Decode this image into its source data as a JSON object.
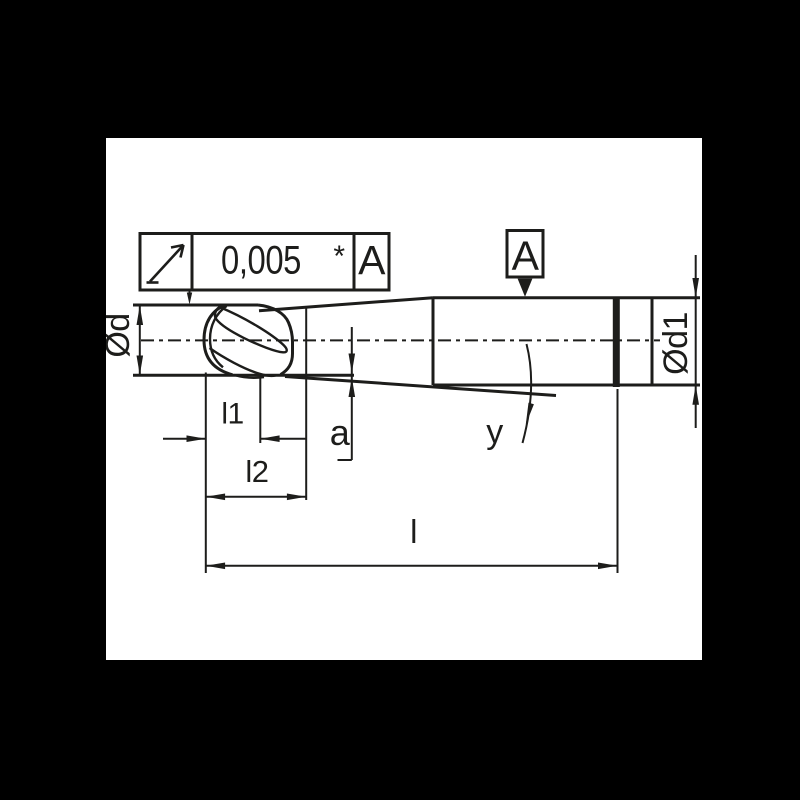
{
  "colors": {
    "background": "#000000",
    "paper": "#ffffff",
    "ink": "#1d1d1b"
  },
  "feature_control_frame": {
    "symbol": "circular-runout-arrow",
    "tolerance": "0,005",
    "note": "*",
    "datum_ref": "A"
  },
  "datum_flag": {
    "label": "A"
  },
  "dimensions": {
    "d_label": "Ød",
    "d1_label": "Ød1",
    "l1_label": "l1",
    "l2_label": "l2",
    "a_label": "a",
    "angle_label": "y",
    "overall_length_label": "l"
  }
}
